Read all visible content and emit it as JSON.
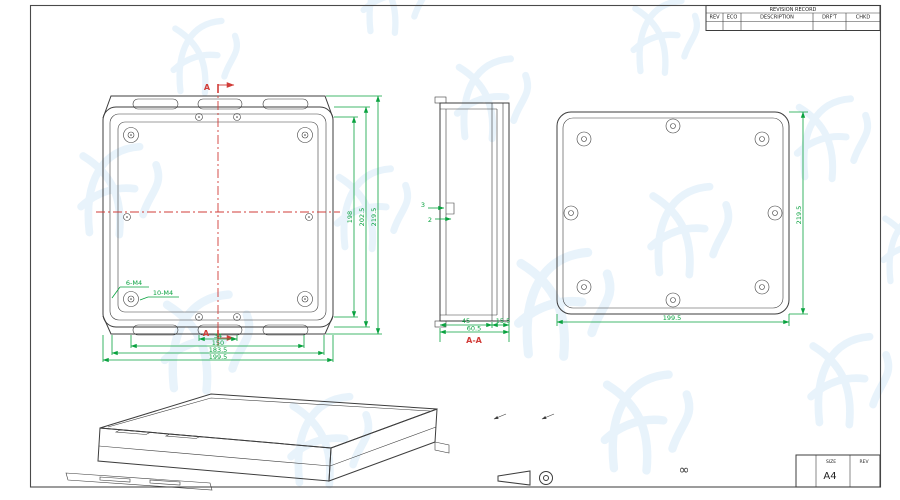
{
  "drawing": {
    "watermark_text": "鸿发顺达",
    "colors": {
      "line": "#3d3d3d",
      "dimension": "#09a23f",
      "section_mark": "#d13c38",
      "watermark": "#d6e9f8"
    }
  },
  "revision_table": {
    "title": "REVISION RECORD",
    "columns": [
      "REV",
      "ECO",
      "DESCRIPTION",
      "DRF'T",
      "CHKD"
    ]
  },
  "front_view": {
    "section_label": "A",
    "callout_6m4": "6-M4",
    "callout_10m4": "10-M4",
    "dim_inner_height": "198",
    "dim_mid_height": "202.5",
    "dim_outer_height": "219.5",
    "dim_center_span": "34",
    "dim_slot_span": "150",
    "dim_hole_span": "183.5",
    "dim_width": "199.5"
  },
  "section_view": {
    "label": "A-A",
    "dim_wall": "3",
    "dim_step": "2",
    "dim_body_depth": "45",
    "dim_total_depth": "60.5",
    "dim_lid_depth": "15.5"
  },
  "rear_view": {
    "dim_height": "219.5",
    "dim_width": "199.5"
  },
  "symbols": {
    "infinity": "∞"
  },
  "title_block": {
    "size_label": "SIZE",
    "size_value": "A4",
    "rev_label": "REV"
  }
}
